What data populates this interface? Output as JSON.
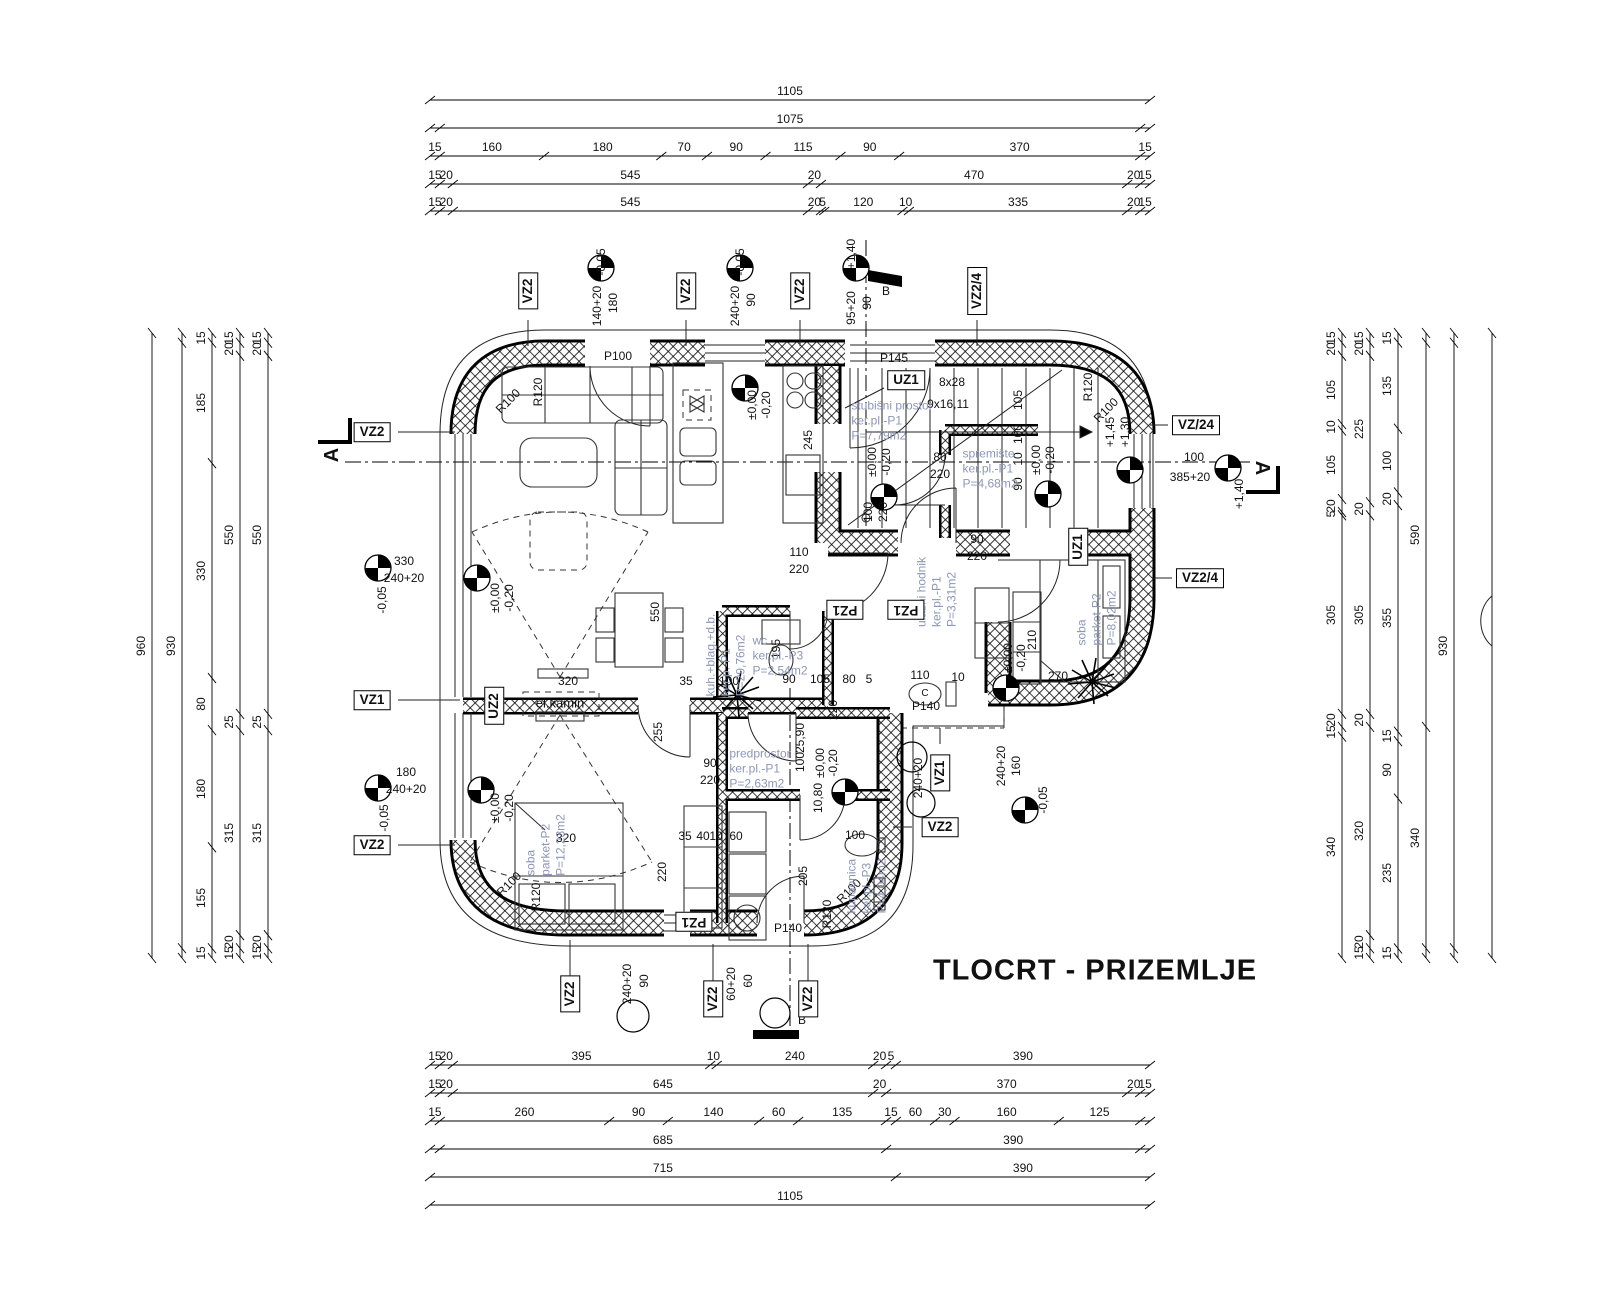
{
  "title": "TLOCRT - PRIZEMLJE",
  "colors": {
    "room_label": "#8d97b5",
    "line": "#111111",
    "background": "#ffffff"
  },
  "dim_chains": {
    "top": {
      "x0": 430,
      "x1": 1150,
      "rows": [
        {
          "y": 100,
          "segs": [
            1105
          ]
        },
        {
          "y": 128,
          "pad": 15,
          "pade": 15,
          "segs": [
            1075
          ]
        },
        {
          "y": 156,
          "segs": [
            15,
            160,
            180,
            70,
            90,
            115,
            90,
            370,
            15
          ]
        },
        {
          "y": 184,
          "segs": [
            15,
            20,
            545,
            20,
            470,
            20,
            15
          ]
        },
        {
          "y": 211,
          "segs": [
            15,
            20,
            545,
            20,
            5,
            120,
            10,
            335,
            20,
            15
          ]
        }
      ]
    },
    "bottom": {
      "x0": 430,
      "x1": 1150,
      "rows": [
        {
          "y": 1065,
          "segs": [
            15,
            20,
            395,
            10,
            240,
            20,
            {
              "v": 15,
              "l": "5"
            },
            390
          ]
        },
        {
          "y": 1093,
          "segs": [
            15,
            20,
            645,
            20,
            370,
            20,
            15
          ]
        },
        {
          "y": 1121,
          "segs": [
            15,
            260,
            90,
            140,
            60,
            135,
            15,
            60,
            30,
            160,
            125,
            {
              "v": 15,
              "l": ""
            }
          ]
        },
        {
          "y": 1149,
          "pad": 15,
          "pade": 15,
          "segs": [
            685,
            390
          ]
        },
        {
          "y": 1177,
          "segs": [
            715,
            390
          ]
        },
        {
          "y": 1205,
          "segs": [
            1105
          ]
        }
      ]
    },
    "left": {
      "y0": 333,
      "y1": 958,
      "cols": [
        {
          "x": 152,
          "segs": [
            960
          ]
        },
        {
          "x": 182,
          "pad": 15,
          "pade": 15,
          "segs": [
            930
          ]
        },
        {
          "x": 212,
          "segs": [
            15,
            185,
            330,
            80,
            180,
            155,
            15
          ]
        },
        {
          "x": 240,
          "segs": [
            15,
            20,
            550,
            25,
            315,
            20,
            15
          ]
        },
        {
          "x": 268,
          "segs": [
            15,
            20,
            550,
            25,
            315,
            20,
            15
          ]
        }
      ]
    },
    "right": {
      "y0": 333,
      "y1": 958,
      "cols": [
        {
          "x": 1342,
          "segs": [
            15,
            20,
            105,
            10,
            105,
            20,
            5,
            305,
            20,
            15,
            340
          ]
        },
        {
          "x": 1370,
          "segs": [
            15,
            20,
            225,
            20,
            305,
            20,
            320,
            20,
            15
          ]
        },
        {
          "x": 1398,
          "segs": [
            15,
            135,
            100,
            20,
            355,
            15,
            90,
            235,
            15
          ]
        },
        {
          "x": 1426,
          "pad": 15,
          "pade": 15,
          "segs": [
            590,
            340
          ]
        },
        {
          "x": 1454,
          "pad": 15,
          "pade": 15,
          "segs": [
            930
          ]
        },
        {
          "x": 1492,
          "segs": [
            {
              "v": 960,
              "l": ""
            }
          ]
        }
      ]
    }
  },
  "rooms": [
    {
      "x": 725,
      "y": 655,
      "r": -90,
      "lines": [
        "kuh.+blag.+d.b.",
        "ker.p.-P1",
        "P=29,76m2"
      ]
    },
    {
      "x": 892,
      "y": 420,
      "r": 0,
      "lines": [
        "stubišni prostor",
        "ker.pl.-P1",
        "P=7,79m2"
      ]
    },
    {
      "x": 990,
      "y": 468,
      "r": 0,
      "lines": [
        "spremište",
        "ker.pl.-P1",
        "P=4,68m2"
      ]
    },
    {
      "x": 936,
      "y": 592,
      "r": -90,
      "lines": [
        "ulazni hodnik",
        "ker.pl.-P1",
        "P=3,31m2"
      ]
    },
    {
      "x": 780,
      "y": 655,
      "r": 0,
      "lines": [
        "wc",
        "ker.pl.-P3",
        "P=2,54m2"
      ]
    },
    {
      "x": 1096,
      "y": 618,
      "r": -90,
      "lines": [
        "soba",
        "parket-P2",
        "P=8,02m2"
      ]
    },
    {
      "x": 545,
      "y": 845,
      "r": -90,
      "lines": [
        "soba",
        "parket-P2",
        "P=12,23m2"
      ]
    },
    {
      "x": 760,
      "y": 768,
      "r": 0,
      "lines": [
        "predprostor",
        "ker.pl.-P1",
        "P=2,63m2"
      ]
    },
    {
      "x": 866,
      "y": 886,
      "r": -90,
      "lines": [
        "kupaonica",
        "ker.pl.-P3",
        "P=4,04m2"
      ]
    }
  ],
  "markers": [
    {
      "t": "VZ2",
      "x": 528,
      "y": 291,
      "o": "v"
    },
    {
      "t": "VZ2",
      "x": 686,
      "y": 291,
      "o": "v"
    },
    {
      "t": "VZ2",
      "x": 800,
      "y": 291,
      "o": "v"
    },
    {
      "t": "VZ2/4",
      "x": 977,
      "y": 291,
      "o": "v"
    },
    {
      "t": "VZ2",
      "x": 372,
      "y": 432,
      "o": "h"
    },
    {
      "t": "VZ1",
      "x": 372,
      "y": 700,
      "o": "h"
    },
    {
      "t": "VZ2",
      "x": 372,
      "y": 845,
      "o": "h"
    },
    {
      "t": "VZ/24",
      "x": 1196,
      "y": 425,
      "o": "h"
    },
    {
      "t": "VZ2/4",
      "x": 1200,
      "y": 578,
      "o": "h"
    },
    {
      "t": "VZ2",
      "x": 940,
      "y": 827,
      "o": "h"
    },
    {
      "t": "UZ1",
      "x": 906,
      "y": 380,
      "o": "h"
    },
    {
      "t": "UZ1",
      "x": 1078,
      "y": 547,
      "o": "v"
    },
    {
      "t": "UZ2",
      "x": 494,
      "y": 706,
      "o": "v"
    },
    {
      "t": "PZ1",
      "x": 845,
      "y": 610,
      "o": "f"
    },
    {
      "t": "PZ1",
      "x": 906,
      "y": 610,
      "o": "f"
    },
    {
      "t": "PZ1",
      "x": 694,
      "y": 922,
      "o": "f"
    },
    {
      "t": "VZ1",
      "x": 940,
      "y": 773,
      "o": "v"
    },
    {
      "t": "VZ2",
      "x": 570,
      "y": 994,
      "o": "v"
    },
    {
      "t": "VZ2",
      "x": 713,
      "y": 999,
      "o": "v"
    },
    {
      "t": "VZ2",
      "x": 808,
      "y": 999,
      "o": "v"
    }
  ],
  "annotations": [
    [
      "-0,05",
      601,
      262,
      -90
    ],
    [
      "140+20",
      597,
      306,
      -90
    ],
    [
      "180",
      613,
      303,
      -90
    ],
    [
      "-0,05",
      740,
      262,
      -90
    ],
    [
      "240+20",
      735,
      306,
      -90
    ],
    [
      "90",
      751,
      300,
      -90
    ],
    [
      "+1,40",
      851,
      254,
      -90
    ],
    [
      "95+20",
      851,
      308,
      -90
    ],
    [
      "90",
      867,
      303,
      -90
    ],
    [
      "B",
      886,
      291,
      0
    ],
    [
      "P100",
      618,
      356,
      0
    ],
    [
      "P145",
      894,
      358,
      0
    ],
    [
      "R120",
      538,
      392,
      -90
    ],
    [
      "R100",
      508,
      401,
      -45
    ],
    [
      "R120",
      1088,
      387,
      -90
    ],
    [
      "R100",
      1106,
      410,
      -45
    ],
    [
      "8x28",
      952,
      382,
      0
    ],
    [
      "9x16,11",
      948,
      404,
      0
    ],
    [
      "105",
      1018,
      400,
      -90
    ],
    [
      "100",
      1018,
      434,
      -90
    ],
    [
      "10",
      1018,
      459,
      -90
    ],
    [
      "90",
      1018,
      484,
      -90
    ],
    [
      "±0,00",
      752,
      405,
      -90
    ],
    [
      "-0,20",
      766,
      405,
      -90
    ],
    [
      "±0,00",
      872,
      462,
      -90
    ],
    [
      "-0,20",
      886,
      462,
      -90
    ],
    [
      "±0,00",
      1036,
      460,
      -90
    ],
    [
      "-0,20",
      1050,
      460,
      -90
    ],
    [
      "80",
      940,
      457,
      0
    ],
    [
      "220",
      940,
      474,
      0
    ],
    [
      "100",
      868,
      512,
      -90
    ],
    [
      "220",
      883,
      512,
      -90
    ],
    [
      "+1,45",
      1110,
      432,
      -90
    ],
    [
      "+1,30",
      1125,
      432,
      -90
    ],
    [
      "100",
      1194,
      457,
      0
    ],
    [
      "385+20",
      1190,
      477,
      0
    ],
    [
      "+1,40",
      1239,
      494,
      -90
    ],
    [
      "245",
      808,
      440,
      -90
    ],
    [
      "550",
      655,
      612,
      -90
    ],
    [
      "330",
      404,
      561,
      0
    ],
    [
      "240+20",
      404,
      578,
      0
    ],
    [
      "-0,05",
      382,
      600,
      -90
    ],
    [
      "±0,00",
      495,
      598,
      -90
    ],
    [
      "-0,20",
      509,
      598,
      -90
    ],
    [
      "320",
      568,
      681,
      0
    ],
    [
      "35",
      686,
      681,
      0
    ],
    [
      "100",
      729,
      681,
      0
    ],
    [
      "90",
      789,
      679,
      0
    ],
    [
      "105",
      820,
      679,
      0
    ],
    [
      "80",
      849,
      679,
      0
    ],
    [
      "5",
      869,
      679,
      0
    ],
    [
      "110",
      920,
      675,
      0
    ],
    [
      "10",
      958,
      677,
      0
    ],
    [
      "270",
      1058,
      676,
      0
    ],
    [
      "195",
      776,
      649,
      -90
    ],
    [
      "110",
      799,
      552,
      0
    ],
    [
      "220",
      799,
      569,
      0
    ],
    [
      "90",
      977,
      539,
      0
    ],
    [
      "220",
      977,
      556,
      0
    ],
    [
      "210",
      1032,
      640,
      -90
    ],
    [
      "±0,00",
      1008,
      658,
      -90
    ],
    [
      "-0,20",
      1021,
      658,
      -90
    ],
    [
      "25,90",
      800,
      738,
      -90
    ],
    [
      "100",
      800,
      762,
      -90
    ],
    [
      "10,80",
      818,
      798,
      -90
    ],
    [
      "220",
      833,
      710,
      -90
    ],
    [
      "255",
      658,
      732,
      -90
    ],
    [
      "90",
      710,
      763,
      0
    ],
    [
      "220",
      710,
      780,
      0
    ],
    [
      "±0,00",
      820,
      763,
      -90
    ],
    [
      "-0,20",
      833,
      763,
      -90
    ],
    [
      "240+20",
      918,
      778,
      -90
    ],
    [
      "240+20",
      1001,
      766,
      -90
    ],
    [
      "160",
      1016,
      766,
      -90
    ],
    [
      "-0,05",
      1043,
      800,
      -90
    ],
    [
      "180",
      406,
      772,
      0
    ],
    [
      "240+20",
      406,
      789,
      0
    ],
    [
      "-0,05",
      384,
      818,
      -90
    ],
    [
      "±0,00",
      495,
      808,
      -90
    ],
    [
      "-0,20",
      509,
      808,
      -90
    ],
    [
      "320",
      566,
      838,
      0
    ],
    [
      "35",
      685,
      836,
      0
    ],
    [
      "40",
      703,
      836,
      0
    ],
    [
      "10",
      716,
      836,
      0
    ],
    [
      "60",
      736,
      836,
      0
    ],
    [
      "220",
      662,
      872,
      -90
    ],
    [
      "205",
      803,
      876,
      -90
    ],
    [
      "100",
      855,
      835,
      0
    ],
    [
      "R100",
      509,
      884,
      -45
    ],
    [
      "R120",
      536,
      897,
      -90
    ],
    [
      "R100",
      849,
      891,
      -45
    ],
    [
      "R120",
      827,
      914,
      -90
    ],
    [
      "P140",
      926,
      706,
      0
    ],
    [
      "P140",
      788,
      928,
      0
    ],
    [
      "240+20",
      627,
      984,
      -90
    ],
    [
      "90",
      644,
      981,
      -90
    ],
    [
      "60+20",
      731,
      984,
      -90
    ],
    [
      "60",
      748,
      981,
      -90
    ],
    [
      "B",
      802,
      1020,
      0
    ],
    [
      "el.kamin",
      560,
      703,
      0,
      "k"
    ],
    [
      "A",
      332,
      455,
      -90,
      "A"
    ],
    [
      "A",
      1262,
      468,
      90,
      "A"
    ],
    [
      "C",
      925,
      694,
      0,
      "c"
    ]
  ],
  "levels": [
    [
      601,
      268
    ],
    [
      740,
      268
    ],
    [
      856,
      268
    ],
    [
      378,
      568
    ],
    [
      477,
      578
    ],
    [
      378,
      788
    ],
    [
      481,
      790
    ],
    [
      745,
      388
    ],
    [
      884,
      497
    ],
    [
      1048,
      494
    ],
    [
      1006,
      688
    ],
    [
      845,
      792
    ],
    [
      1025,
      810
    ],
    [
      1130,
      470
    ],
    [
      1228,
      468
    ]
  ],
  "circles": [
    [
      633,
      1016,
      16
    ],
    [
      912,
      757,
      15
    ],
    [
      921,
      803,
      14
    ],
    [
      775,
      1013,
      15
    ]
  ]
}
